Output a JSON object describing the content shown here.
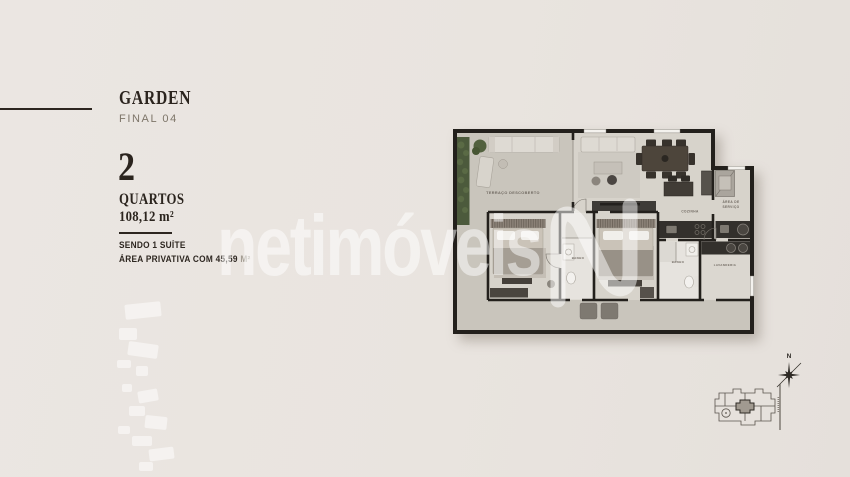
{
  "panel": {
    "title": "GARDEN",
    "subtitle": "FINAL 04",
    "bedrooms_count": "2",
    "bedrooms_label": "QUARTOS",
    "area_label": "108,12 m²",
    "note_1": "SENDO 1 SUÍTE",
    "note_2": "ÁREA PRIVATIVA COM 45,59",
    "note_2_unit": "M²"
  },
  "floor_plan": {
    "labels": {
      "terrace": "TERRAÇO DESCOBERTO",
      "kitchen": "COZINHA",
      "service_area_line1": "ÁREA DE",
      "service_area_line2": "SERVIÇO",
      "bathroom_suite": "BANHO",
      "bathroom_2": "BANHO",
      "laundry": "LAVANDERIA"
    }
  },
  "watermark": {
    "text": "netimóveis"
  },
  "compass": {
    "north_label": "N"
  },
  "colors": {
    "background": "#e9e4df",
    "text_dark": "#2d2620",
    "text_muted": "#7d7569",
    "wall": "#23201c",
    "floor": "#d7d3cb",
    "terrace_floor": "#c9c5bc",
    "hedge_green": "#4c5a3c",
    "dark_furniture": "#33302c",
    "watermark_white": "rgba(255,255,255,0.5)"
  }
}
